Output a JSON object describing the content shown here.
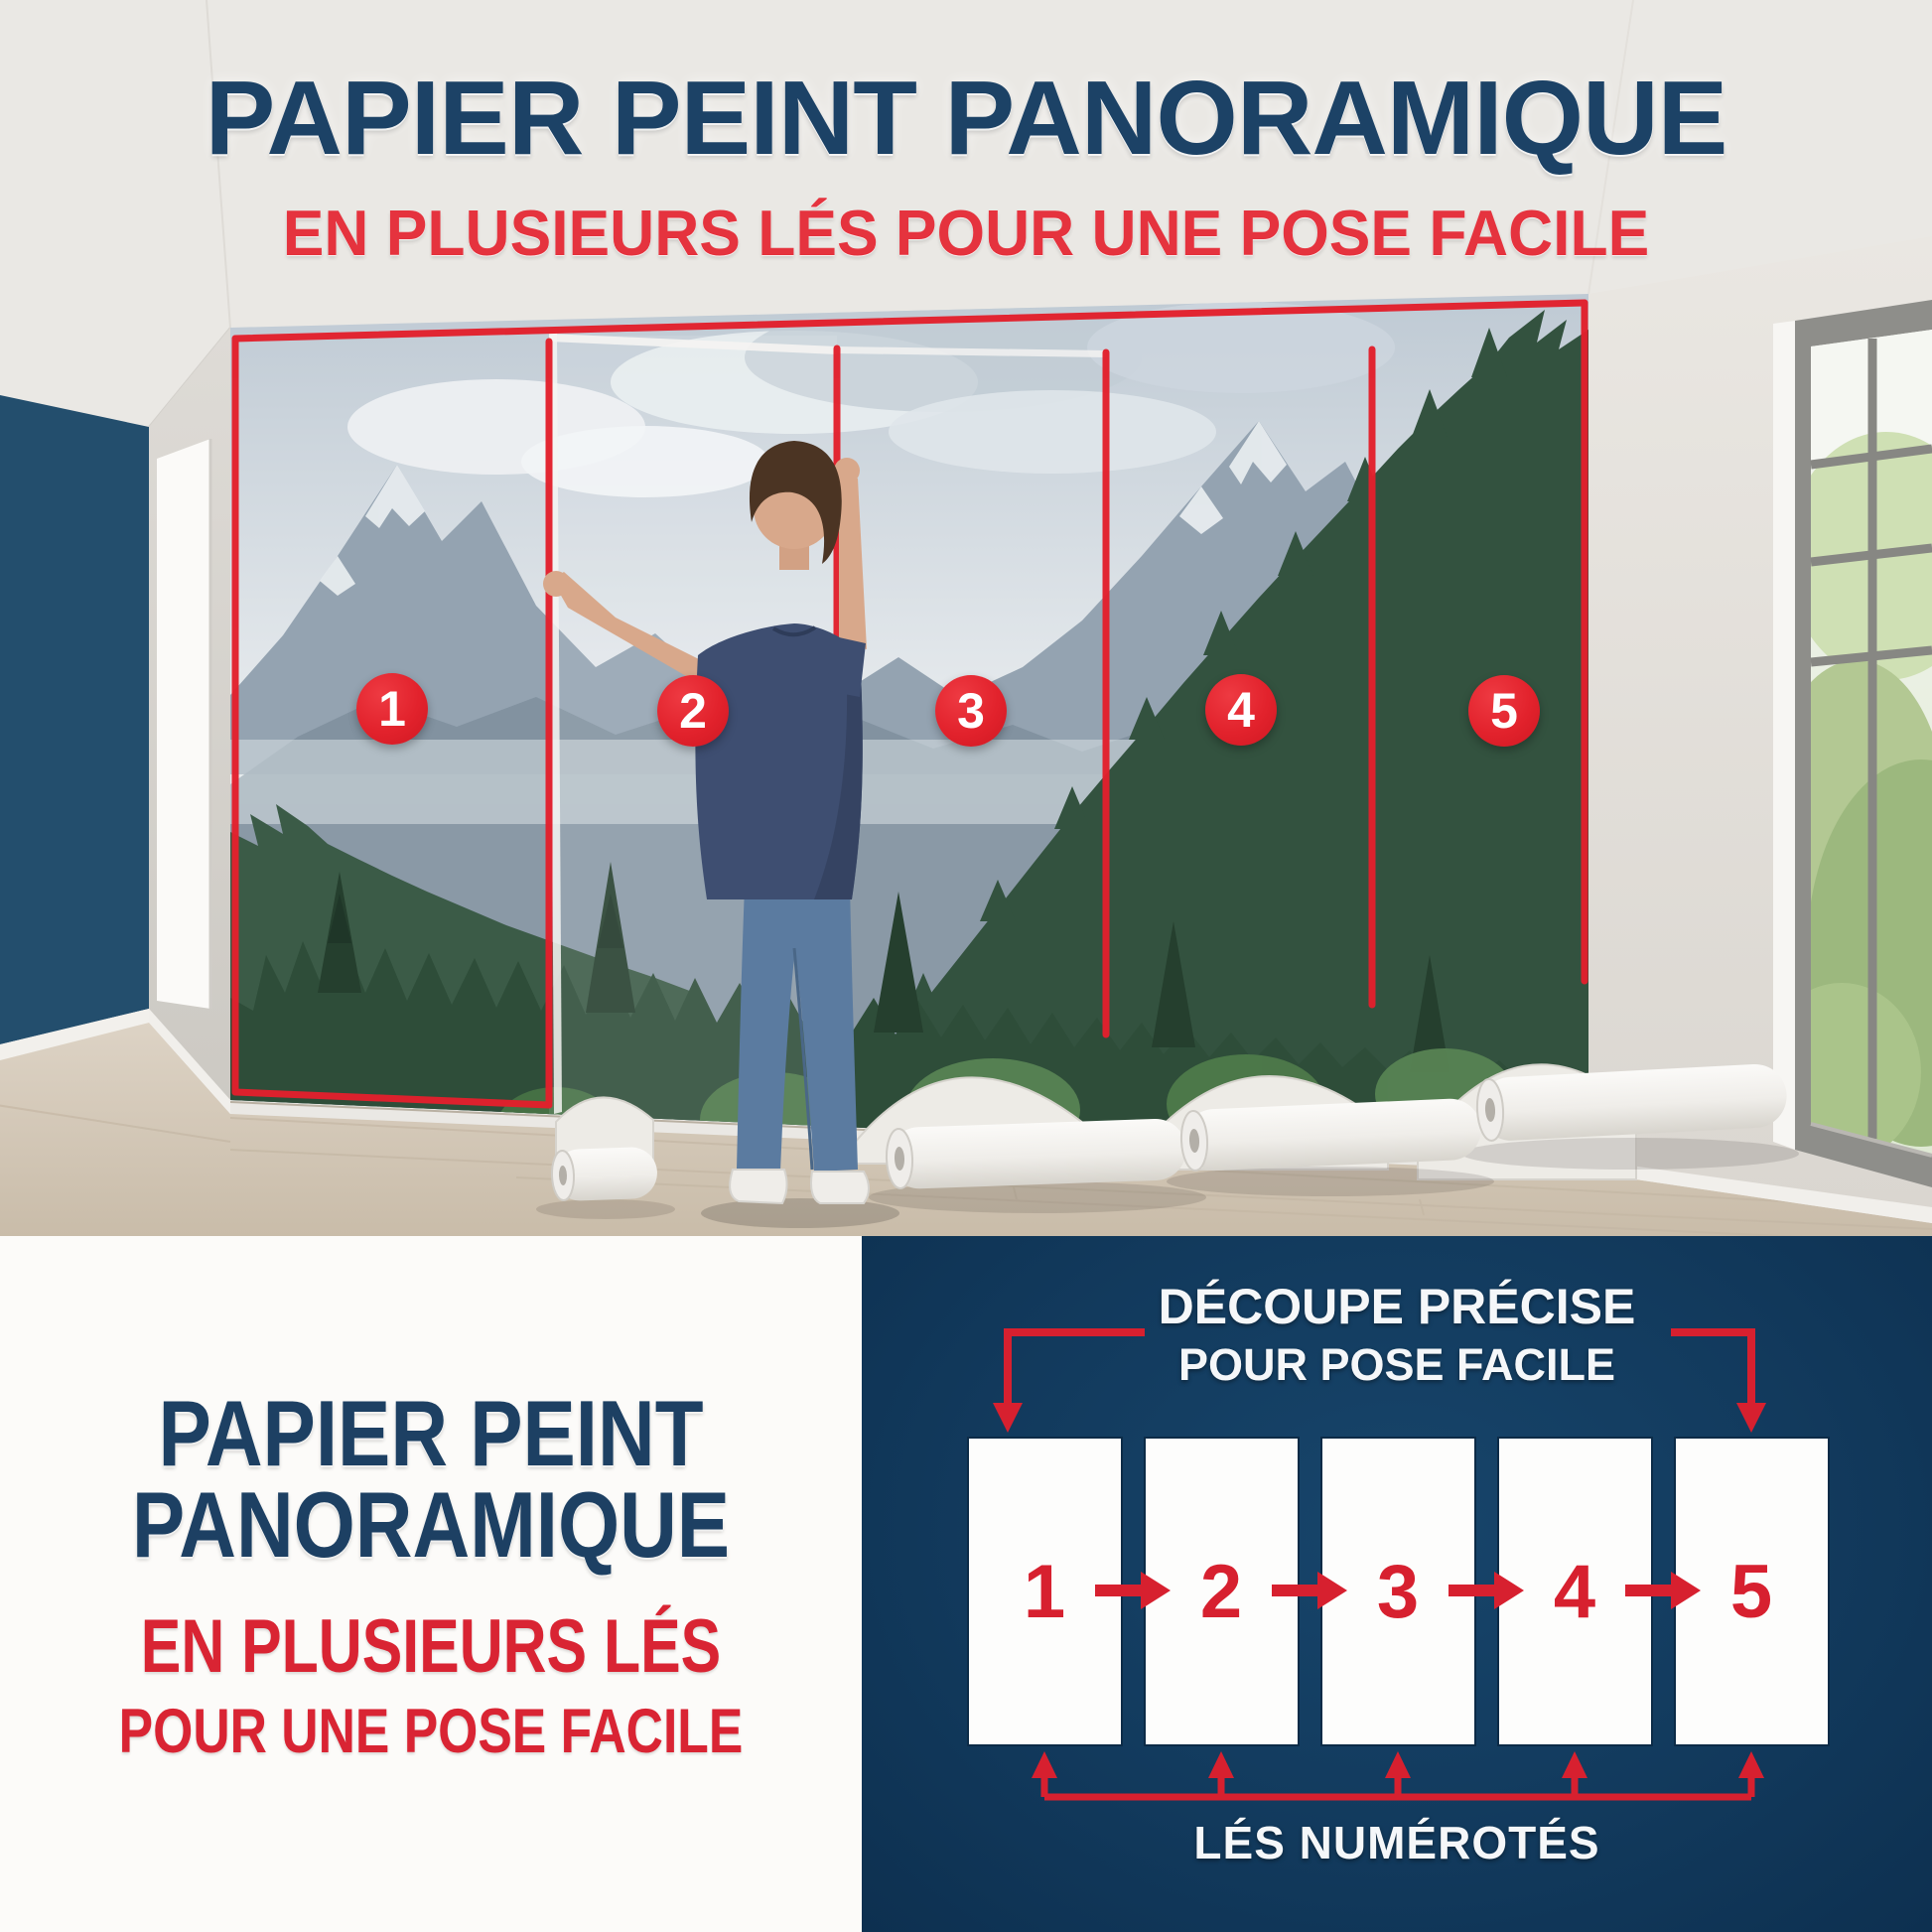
{
  "hero": {
    "title": "PAPIER PEINT PANORAMIQUE",
    "subtitle": "EN PLUSIEURS LÉS POUR UNE POSE FACILE"
  },
  "photo": {
    "strip_numbers": [
      "1",
      "2",
      "3",
      "4",
      "5"
    ]
  },
  "card": {
    "title_line1": "PAPIER PEINT",
    "title_line2": "PANORAMIQUE",
    "subtitle_line1": "EN PLUSIEURS LÉS",
    "subtitle_line2": "POUR UNE POSE FACILE"
  },
  "diagram": {
    "title_line1": "DÉCOUPE PRÉCISE",
    "title_line2": "POUR POSE FACILE",
    "strip_numbers": [
      "1",
      "2",
      "3",
      "4",
      "5"
    ],
    "caption": "LÉS NUMÉROTÉS"
  },
  "colors": {
    "navy_heading": "#1c4266",
    "red_accent": "#e2222c",
    "diagram_navy": "#123a5d",
    "diagram_red": "#d7202f",
    "card_red": "#d92433"
  }
}
